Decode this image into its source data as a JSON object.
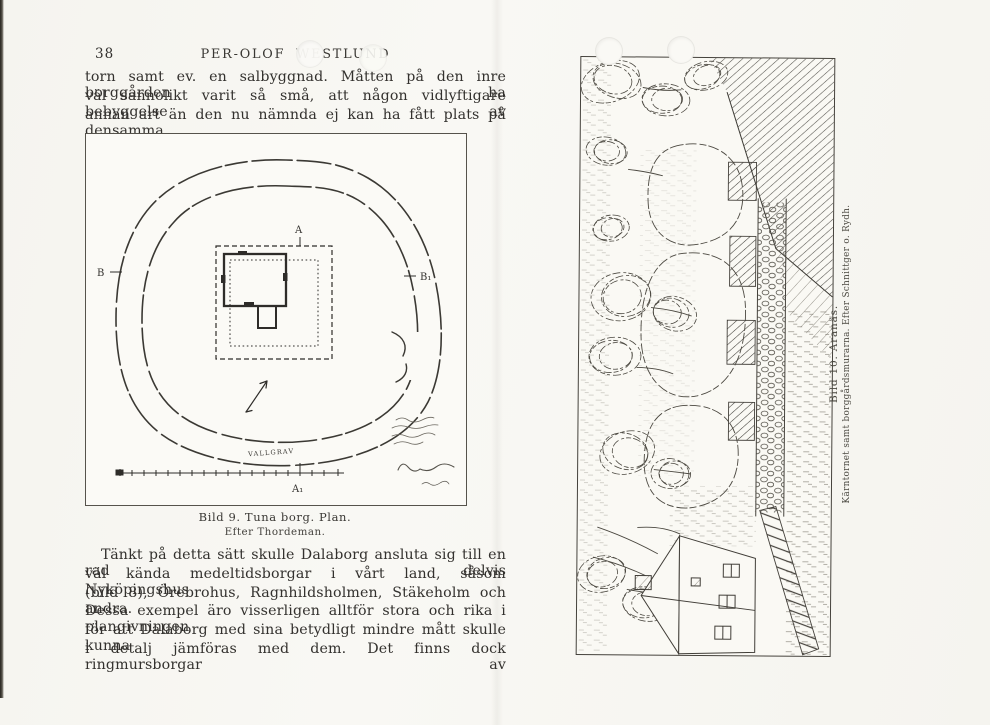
{
  "left_page": {
    "page_number": "38",
    "running_header": "PER-OLOF WESTLUND",
    "top_paragraph_lines": [
      "torn samt ev. en salbyggnad.  Måtten på den inre borggården ha",
      "väl sannolikt varit så små, att någon vidlyftigare bebyggelse av",
      "annan art än den nu nämnda ej kan ha fått plats på densamma."
    ],
    "plan_figure": {
      "labels": {
        "top": "A",
        "bottom": "A₁",
        "left": "B",
        "right": "B₁",
        "moat": "VALLGRAV"
      },
      "caption": "Bild 9.  Tuna borg.  Plan.",
      "caption_credit": "Efter Thordeman."
    },
    "bottom_paragraph_lines": [
      "Tänkt  på detta sätt skulle Dalaborg ansluta sig till en rad delvis",
      "väl kända medeltidsborgar i vårt land, såsom Nyköpingshus",
      "(bild 8), Örebrohus, Ragnhildsholmen, Stäkeholm och andra.",
      "Dessa exempel äro visserligen alltför stora och rika i plangivningen",
      "för att Dalaborg med sina betydligt mindre mått skulle kunna",
      "i detalj jämföras med dem.  Det finns dock ringmursborgar av"
    ]
  },
  "right_page": {
    "illustration_caption": {
      "title": "Bild 10.  Aranäs.",
      "subtitle": "Kärntornet samt borggårdsmurarna.  Efter Schnittger o. Rydh."
    }
  }
}
